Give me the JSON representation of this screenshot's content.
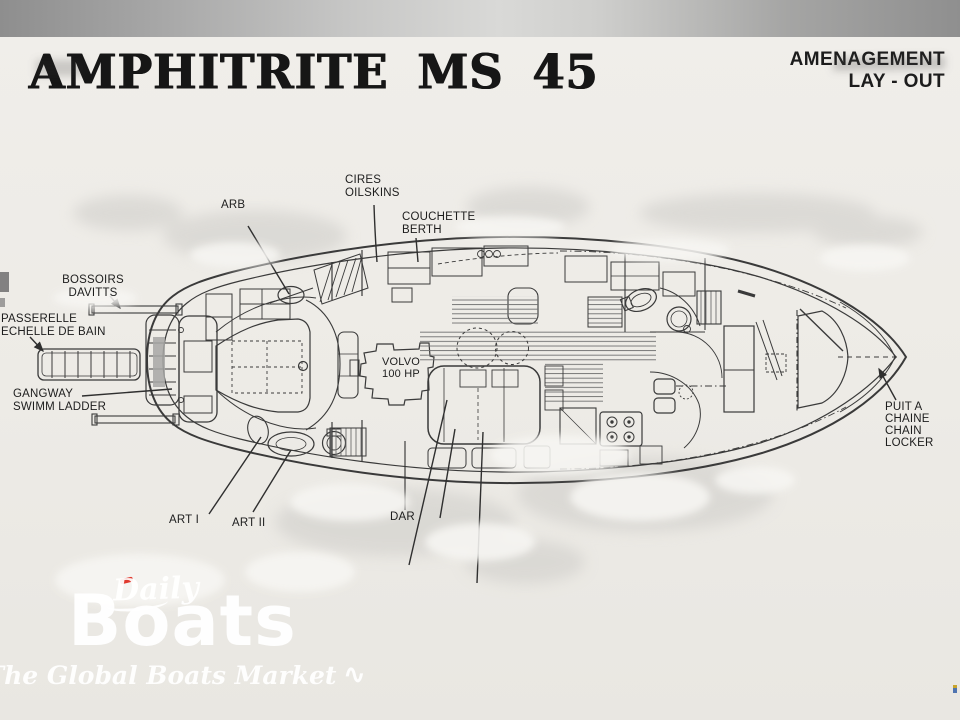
{
  "header": {
    "title": "AMPHITRITE MS 45",
    "corner_line1": "AMENAGEMENT",
    "corner_line2": "LAY - OUT"
  },
  "diagram_labels": {
    "arb": "ARB",
    "cires_oilskins": "CIRES\nOILSKINS",
    "couchette_berth": "COUCHETTE\nBERTH",
    "bossoirs_davitts": "BOSSOIRS\nDAVITTS",
    "passerelle_echelle": "PASSERELLE\nECHELLE DE BAIN",
    "gangway_ladder": "GANGWAY\nSWIMM LADDER",
    "engine": "VOLVO\n100 HP",
    "chain_locker": "PUIT A\nCHAINE\nCHAIN\nLOCKER",
    "art_1": "ART I",
    "art_2": "ART II",
    "dar": "DAR"
  },
  "watermark": {
    "brand_top": "Daily",
    "brand_main": "Boats",
    "tagline": "The Global Boats Market",
    "flourish_left": "∿",
    "flourish_right": "∿"
  },
  "colors": {
    "page_bg": "#edebe6",
    "scan_bar_gray": "#9a9a9a",
    "ink": "#2f2f2f",
    "watermark_white": "#ffffff",
    "logo_red": "#e0392e"
  }
}
